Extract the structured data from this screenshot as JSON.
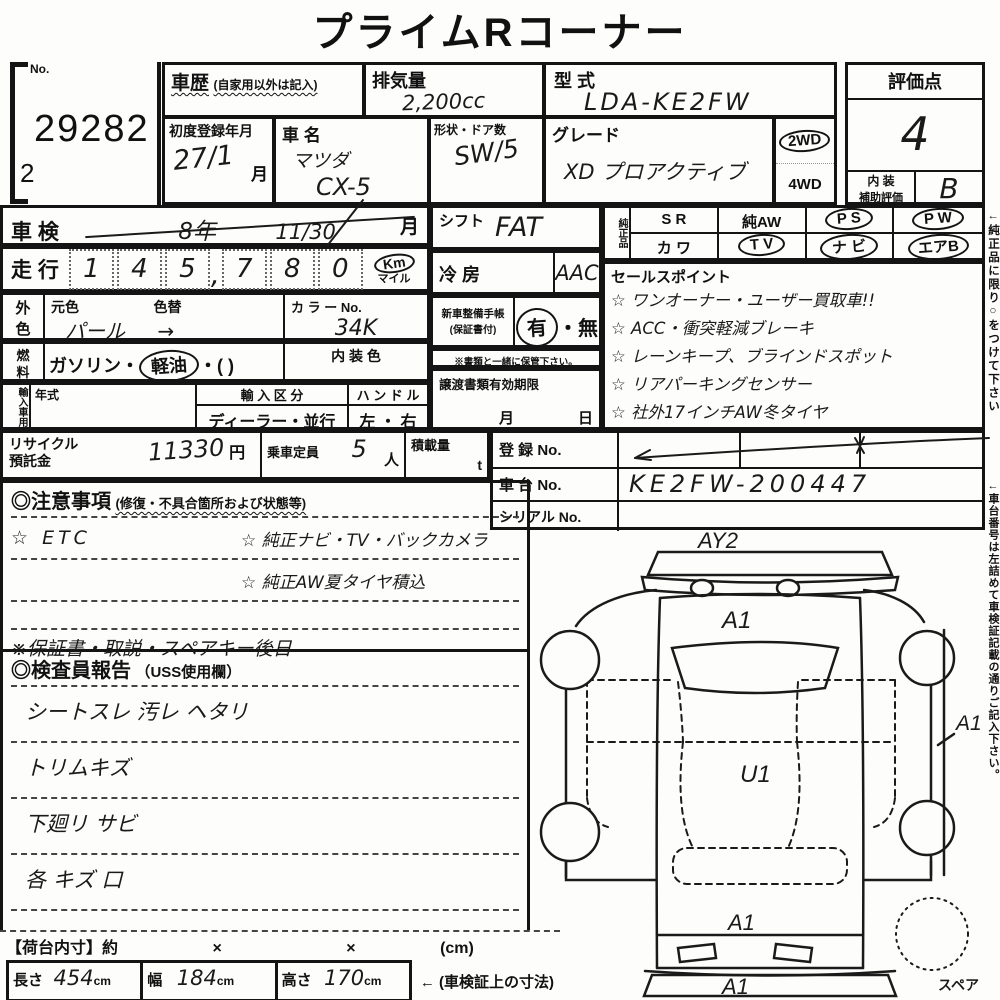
{
  "title": "プライムRコーナー",
  "no_block": {
    "label": "No.",
    "number": "29282",
    "sub": "2"
  },
  "history": {
    "label": "車歴",
    "note": "(自家用以外は記入)"
  },
  "displacement": {
    "label": "排気量",
    "value": "2,200cc"
  },
  "model_code": {
    "label": "型  式",
    "value": "LDA-KE2FW"
  },
  "first_reg": {
    "label": "初度登録年月",
    "value": "27/1",
    "unit": "月"
  },
  "car_name": {
    "label": "車  名",
    "maker": "マツダ",
    "model": "CX-5"
  },
  "shape_doors": {
    "label": "形状・ドア数",
    "value": "SW/5"
  },
  "grade": {
    "label": "グレード",
    "value": "XD プロアクティブ",
    "drive_top": "2WD",
    "drive_bottom": "4WD"
  },
  "score": {
    "label": "評価点",
    "value": "4",
    "interior_l1": "内 装",
    "interior_l2": "補助評価",
    "interior_value": "B"
  },
  "shaken": {
    "label": "車 検",
    "era": "8年",
    "date": "11/30",
    "unit": "月"
  },
  "mileage": {
    "label": "走 行",
    "digits": [
      "1",
      "4",
      "5",
      "7",
      "8",
      "0"
    ],
    "comma": ",",
    "unit_km": "Km",
    "unit_mile": "マイル"
  },
  "ext_color": {
    "side1": "外",
    "side2": "色",
    "base_label": "元色",
    "base_value": "パール",
    "arrow": "→",
    "change_label": "色替",
    "color_no_label": "カ ラ ー No.",
    "color_no": "34K"
  },
  "fuel": {
    "side1": "燃",
    "side2": "料",
    "pre": "ガソリン・",
    "selected": "軽油",
    "post": "・(          )",
    "interior_color_label": "内 装 色"
  },
  "import_block": {
    "side": "輸入車用",
    "year_label": "年式",
    "division_label": "輸 入 区 分",
    "division_value": "ディーラー・並行",
    "handle_label": "ハ ン ド ル",
    "handle_value": "左 ・ 右"
  },
  "shift": {
    "label": "シフト",
    "value": "FAT"
  },
  "ac": {
    "label": "冷  房",
    "value": "AAC"
  },
  "service_book": {
    "label1": "新車整備手帳",
    "label2": "(保証書付)",
    "yes": "有",
    "dot": "・",
    "no": "無",
    "note": "※書類と一緒に保管下さい。"
  },
  "transfer_docs": {
    "label": "譲渡書類有効期限",
    "month": "月",
    "day": "日"
  },
  "genuine": {
    "side": "純正品",
    "r1c1": "S R",
    "r1c2": "純AW",
    "r1c3": "P S",
    "r1c4": "P W",
    "r2c1": "カ ワ",
    "r2c2": "T V",
    "r2c3": "ナ ビ",
    "r2c4": "エアB"
  },
  "sales": {
    "label": "セールスポイント",
    "items": [
      "☆ ワンオーナー・ユーザー買取車!!",
      "☆ ACC・衝突軽減ブレーキ",
      "☆ レーンキープ、ブラインドスポット",
      "☆ リアパーキングセンサー",
      "☆ 社外17インチAW冬タイヤ"
    ]
  },
  "recycle": {
    "label1": "リサイクル",
    "label2": "預託金",
    "value": "11330",
    "unit": "円"
  },
  "capacity": {
    "label": "乗車定員",
    "value": "5",
    "unit": "人"
  },
  "load": {
    "label": "積載量",
    "unit": "t"
  },
  "registration": {
    "reg_label": "登  録  No.",
    "chassis_label": "車  台  No.",
    "chassis_value": "KE2FW-200447",
    "serial_label": "シリアル No."
  },
  "notes": {
    "label": "◎注意事項",
    "sub": "(修復・不具合箇所および状態等)",
    "row1_left": "☆ ETC",
    "row1_right": "☆ 純正ナビ・TV・バックカメラ",
    "row2_right": "☆ 純正AW夏タイヤ積込",
    "bottom": "※保証書・取説・スペアキー後日"
  },
  "inspector": {
    "label": "◎検査員報告",
    "sub": "（USS使用欄）",
    "lines": [
      "シートスレ 汚レ ヘタリ",
      "トリムキズ",
      "下廻リ サビ",
      "各 キズ 口"
    ]
  },
  "diagram": {
    "top": "AY2",
    "hood": "A1",
    "roof": "U1",
    "side": "A1",
    "tail": "A1",
    "bumper": "A1",
    "spare": "スペア"
  },
  "dims": {
    "header": "【荷台内寸】約",
    "x1": "×",
    "x2": "×",
    "cm": "(cm)",
    "length_label": "長さ",
    "length": "454",
    "width_label": "幅",
    "width": "184",
    "height_label": "高さ",
    "height": "170",
    "unit": "cm",
    "arrow_note": "← (車検証上の寸法)"
  },
  "side_notes": {
    "note1": "←純正品に限り○をつけて下さい",
    "note2": "←車台番号は左詰めて車検証記載の通りご記入下さい。"
  }
}
